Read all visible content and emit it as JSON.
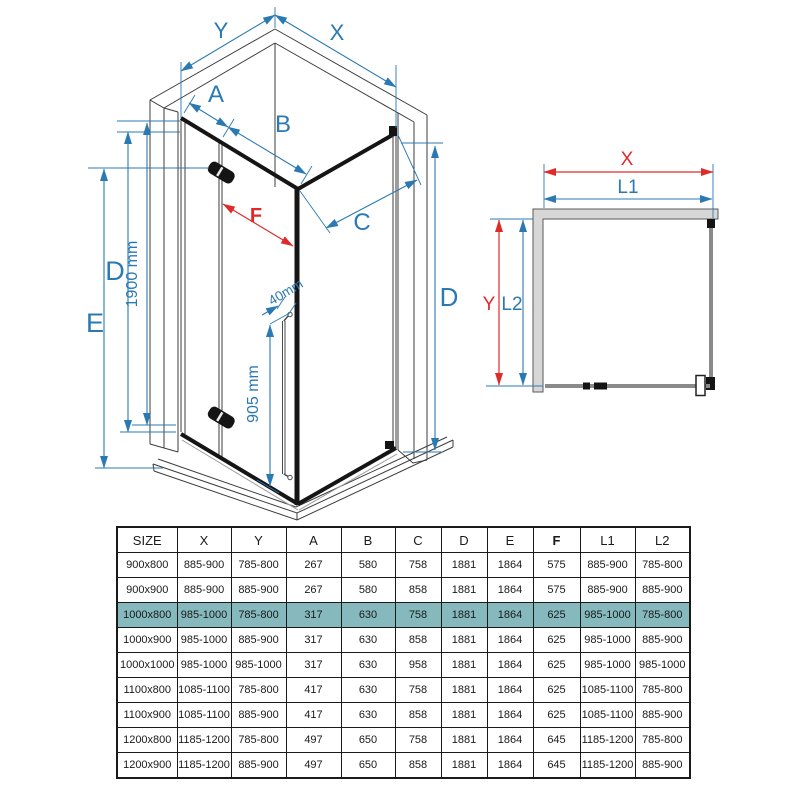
{
  "colors": {
    "dim_blue": "#2b79b3",
    "dim_red": "#e02a2a",
    "row_highlight": "#85b9bd",
    "wall_fill": "#d7d7d7",
    "structure": "#3c3c3c"
  },
  "isometric_view": {
    "width_right_label": "X",
    "width_left_label": "Y",
    "fixed_panel_label": "A",
    "door_label": "B",
    "side_panel_label": "C",
    "door_opening_label": "F",
    "height_left_label": "D",
    "height_outer_label": "E",
    "height_right_label": "D",
    "glass_height_label": "1900 mm",
    "handle_height_label": "905 mm",
    "handle_gap_label": "40mm"
  },
  "top_view": {
    "width_label": "X",
    "inner_width_label": "L1",
    "depth_label": "Y",
    "inner_depth_label": "L2"
  },
  "table": {
    "columns": [
      "SIZE",
      "X",
      "Y",
      "A",
      "B",
      "C",
      "D",
      "E",
      "F",
      "L1",
      "L2"
    ],
    "bold_columns": [
      "F"
    ],
    "highlighted_row": 2,
    "rows": [
      [
        "900x800",
        "885-900",
        "785-800",
        "267",
        "580",
        "758",
        "1881",
        "1864",
        "575",
        "885-900",
        "785-800"
      ],
      [
        "900x900",
        "885-900",
        "885-900",
        "267",
        "580",
        "858",
        "1881",
        "1864",
        "575",
        "885-900",
        "885-900"
      ],
      [
        "1000x800",
        "985-1000",
        "785-800",
        "317",
        "630",
        "758",
        "1881",
        "1864",
        "625",
        "985-1000",
        "785-800"
      ],
      [
        "1000x900",
        "985-1000",
        "885-900",
        "317",
        "630",
        "858",
        "1881",
        "1864",
        "625",
        "985-1000",
        "885-900"
      ],
      [
        "1000x1000",
        "985-1000",
        "985-1000",
        "317",
        "630",
        "958",
        "1881",
        "1864",
        "625",
        "985-1000",
        "985-1000"
      ],
      [
        "1100x800",
        "1085-1100",
        "785-800",
        "417",
        "630",
        "758",
        "1881",
        "1864",
        "625",
        "1085-1100",
        "785-800"
      ],
      [
        "1100x900",
        "1085-1100",
        "885-900",
        "417",
        "630",
        "858",
        "1881",
        "1864",
        "625",
        "1085-1100",
        "885-900"
      ],
      [
        "1200x800",
        "1185-1200",
        "785-800",
        "497",
        "650",
        "758",
        "1881",
        "1864",
        "645",
        "1185-1200",
        "785-800"
      ],
      [
        "1200x900",
        "1185-1200",
        "885-900",
        "497",
        "650",
        "858",
        "1881",
        "1864",
        "645",
        "1185-1200",
        "885-900"
      ]
    ]
  }
}
